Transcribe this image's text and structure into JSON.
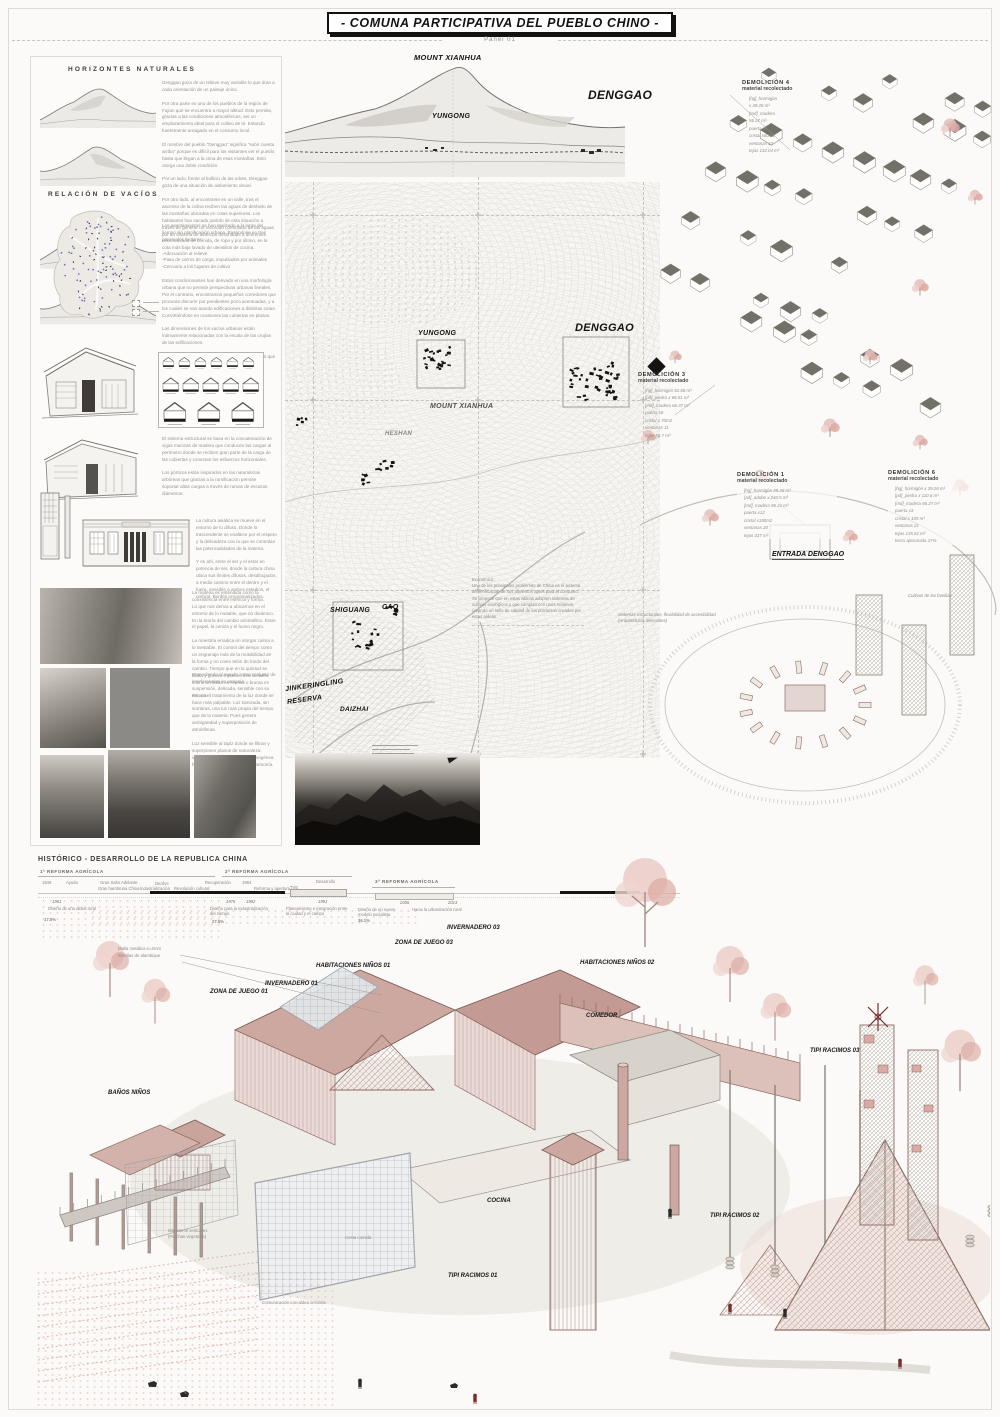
{
  "header": {
    "title": "- COMUNA PARTICIPATIVA DEL PUEBLO CHINO -",
    "panel": "Panel 01"
  },
  "left_panel": {
    "horizontes_title": "HORIZONTES NATURALES",
    "horizontes_text": "Denggao goza de un relieve muy variable lo que dota a cada orientación de un paisaje único.\n\nPor otra parte es uno de los pueblos de la región de Fujian que se encuentra a mayor altitud. Esto permite, gracias a las condiciones atmosféricas, ser un emplazamiento ideal para el cultivo de té. Estando fuertemente arraigado en el consumo local.\n\nEl nombre del pueblo \"Denggao\" significa \"subir cuesta arriba\" porque es difícil para los visitantes ver el pueblo hasta que llegan a la cima de esas montañas. Esto otorga una doble condición.\n\nPor un lado, frente al bullicio de las urbes, Denggao goza de una situación de aislamiento visual.\n\nPor otro lado, al encontrarse en un valle, tras el ascenso de la colina reciben las aguas de deshielo de las montañas ubicadas en cotas superiores. Los habitantes han sacado partido de esta situación a través de generar un recorrido controlado de las aguas por un sistema de albercas destinadas a diferentes usos: Lavado de comida, de ropa y por último, en la cota más baja lavado de utensilios de cocina.",
    "vacios_title": "RELACIÓN DE VACÍOS",
    "vacios_text": "Los asentamientos se han realizado a lo largo del tiempo sin planificación urbana. Basándose en tres principales factores:\n\n-Adecuación al relieve\n-Paso de carros de carga, impulsados por animales\n-Cercanía a los lugares de cultivo\n\nEstos condicionantes han derivado en una morfología urbana que no permite perspectivas urbanas lineales. Por el contrario, encontramos pequeños corredores que procuran discurrir por pendientes poco acentuadas, y a los cuales se van atando edificaciones a distintas cotas. Convirtiéndose en ocasiones las cubiertas en plazas.\n\nLas dimensiones de los vacíos urbanos están íntimamente relacionadas con la escala de las crujías de las edificaciones.\n\nLas plazas son más cercanas a patios compartidos que a espacios de escala pública.",
    "estructura_text": "El sistema estructural se basa en la concatenación de vigas macizas de madera que conducen las cargas al perímetro donde se reciben gran parte de la carga de las cubiertas y conectan los esfuerzos horizontales.\n\nLos pórticos están inspirados en las naturalezas arbóreas que gracias a la ramificación permite soportar altas cargas a través de ramas de escasos diámetros.",
    "cultura_text_1": "La cultura asiática se mueve en el entorno de lo difuso. Donde lo trascendente se enaltece por el respeto y la delicadeza con la que se controlan las potencialidades de la materia.\n\nY es ahí, entre el ser y el estar en potencia de ser, donde la cultura china ubica sus límites difusos, desdibujados, a medio camino entre el dentro y el fuera, sensible a ambos estadios, el umbral. Bordes programatizados.",
    "cultura_text_2": "La materia es entendida como la coexistencia entre esencia y forma.\nLo que nos deriva a ubicarnos en el entorno de lo mutable, que no dinámico. En la teoría del cambio aristotélico. Entre el papel, la ceniza y el humo negro.\n\nLa maestría erradica en otorgar calma a lo inestable. El control del tiempo como un engranaje más de la mutabilidad de la forma y no como telón de fondo del cambio. Tiempo que en la quietud se dilata y genera espacios intersticiales. Como un fluido en reposo o bruma en suspensión, delicada, sensible con su entorno.",
    "cultura_text_3": "Entendiendo el mundo como conjunto de interferencias en armonía.\n\nEs con el tratamiento de la luz donde se hace más palpable. Luz tamizada, sin sombras, una luz más propia del tiempo que de la materia. Pues genera ambigüedad y superposición de atmósferas.\n\nLuz sensible al tapiz donde se filtran y superponen planos de naturaleza: viento, aromas... Atmósfera homogénea formada por singularidades en armonía."
  },
  "panorama": {
    "mount_xianhua": "MOUNT XIANHUA",
    "yungong": "YUNGONG",
    "denggao": "DENGGAO"
  },
  "map": {
    "yungong": "YUNGONG",
    "denggao": "DENGGAO",
    "mount_xianhua": "MOUNT XIANHUA",
    "heshan": "HESHAN",
    "shiguang": "SHIGUANG",
    "cao": "CAO",
    "reserva": "JINKERINGLING\nRESERVA",
    "daizhai": "DAIZHAI"
  },
  "right_panel": {
    "demolicion_4": {
      "title": "DEMOLICIÓN 4",
      "subtitle": "material recolectado",
      "items": "[hg]_hormigón\nx 49.28 m³\n[md]_madera\n56.27 m³\npuerta x4\ncristal x60m2\nventanas 10\ntejas 132.04 m³"
    },
    "demolicion_3": {
      "title": "DEMOLICIÓN 3",
      "subtitle": "material recolectado",
      "items": "[hg]_hormigón 82.68 m³\n[pd]_piedra x 68.51 m³\n[md]_madera 66.37 m³\npuerta x6\ncristal x 70m2\nventanas 11\ntejas 58.7 m³"
    },
    "demolicion_1": {
      "title": "DEMOLICIÓN 1",
      "subtitle": "material recolectado",
      "items": "[hg]_hormigón 99.28 m³\n[ad]_adobe x 240.5 m³\n[md]_madera 96.21 m³\npuerta x12\ncristal x180m2\nventanas 20\ntejas 337 m³"
    },
    "demolicion_6": {
      "title": "DEMOLICIÓN 6",
      "subtitle": "material recolectado",
      "items": "[hg]_hormigón x 39.26 m³\n[pd]_piedra x 110.6 m³\n[md]_madera 56.27 m³\npuerta x3\ncristal x 109 m³\nventanas 21\ntejas 135.51 m³\ntierra apisonada 27%"
    },
    "entrada": "ENTRADA DENGGAO",
    "cultivos": "Cultivos de las familias",
    "economico": "Económico.\nUno de los principales problemas de China es el sistema de verificación de sus alimentos aptos para el consumo.\nSe propone que en estas aldeas adopten sistemas de cultivos ecológicos y que cumplan con unos mínimos, creando un sello de calidad de los productos creados por estas aldeas.",
    "sistemas": "Sistemas estructurales, flexibilidad de accesibilidad\n(Arquitecturas itinerantes)"
  },
  "timeline": {
    "title": "HISTÓRICO - DESARROLLO DE LA REPUBLICA CHINA",
    "era1": "1ª REFORMA AGRÍCOLA",
    "era2": "2ª REFORMA AGRÍCOLA",
    "era3": "3ª REFORMA AGRÍCOLA",
    "e_1949": "1949",
    "e_ayuda": "Ayuda",
    "e_gsa": "Gran Salto Adelante",
    "e_declive": "Declive",
    "e_hambruna": "Gran hambruna China",
    "e_indus": "Industrialización",
    "e_revcult": "Revolución cultural",
    "e_recup": "Recuperación",
    "e_1964": "1964",
    "e_reforma": "Reforma y apertura",
    "e_tve": "TVE",
    "e_des": "Desarrollo",
    "y_1961": "1961",
    "y_1976": "1976",
    "y_1982": "1982",
    "y_1991": "1991",
    "y_2006": "2006",
    "y_2013": "2013",
    "n1": "Diseño de una aldea rural",
    "n2": "Diseño para la industrialización del campo",
    "n3": "Planeamiento e integración entre la ciudad y el campo",
    "n4": "Diseño de un nuevo modelo socialista",
    "n5": "Hacia la urbanización rural",
    "p1": "17.5%",
    "p2": "27.5%",
    "p3": "36.1%"
  },
  "axon": {
    "labels": {
      "zona_juego_03": "ZONA DE JUEGO 03",
      "invernadero_03": "INVERNADERO 03",
      "hab_ninos_01": "HABITACIONES NIÑOS 01",
      "hab_ninos_02": "HABITACIONES NIÑOS 02",
      "invernadero_01": "INVERNADERO 01",
      "zona_juego_01": "ZONA DE JUEGO 01",
      "banos_ninos": "BAÑOS NIÑOS",
      "comedor": "COMEDOR",
      "cocina": "COCINA",
      "tipi_01": "TIPI RACIMOS 01",
      "tipi_02": "TIPI RACIMOS 02",
      "tipi_03": "TIPI RACIMOS 03"
    },
    "annotations": {
      "malla": "Malla metálica e=2mm",
      "botellas": "Botellas de alambique",
      "maceteros": "Maceteros verticales\n(Perchas vegetales)",
      "cesta": "Cesta comida",
      "comunicacion": "Comunicación con aldea cercana"
    }
  },
  "colors": {
    "accent_pink": "#dcaaa2",
    "ink": "#161616",
    "line_grey": "#b9b5ae"
  }
}
